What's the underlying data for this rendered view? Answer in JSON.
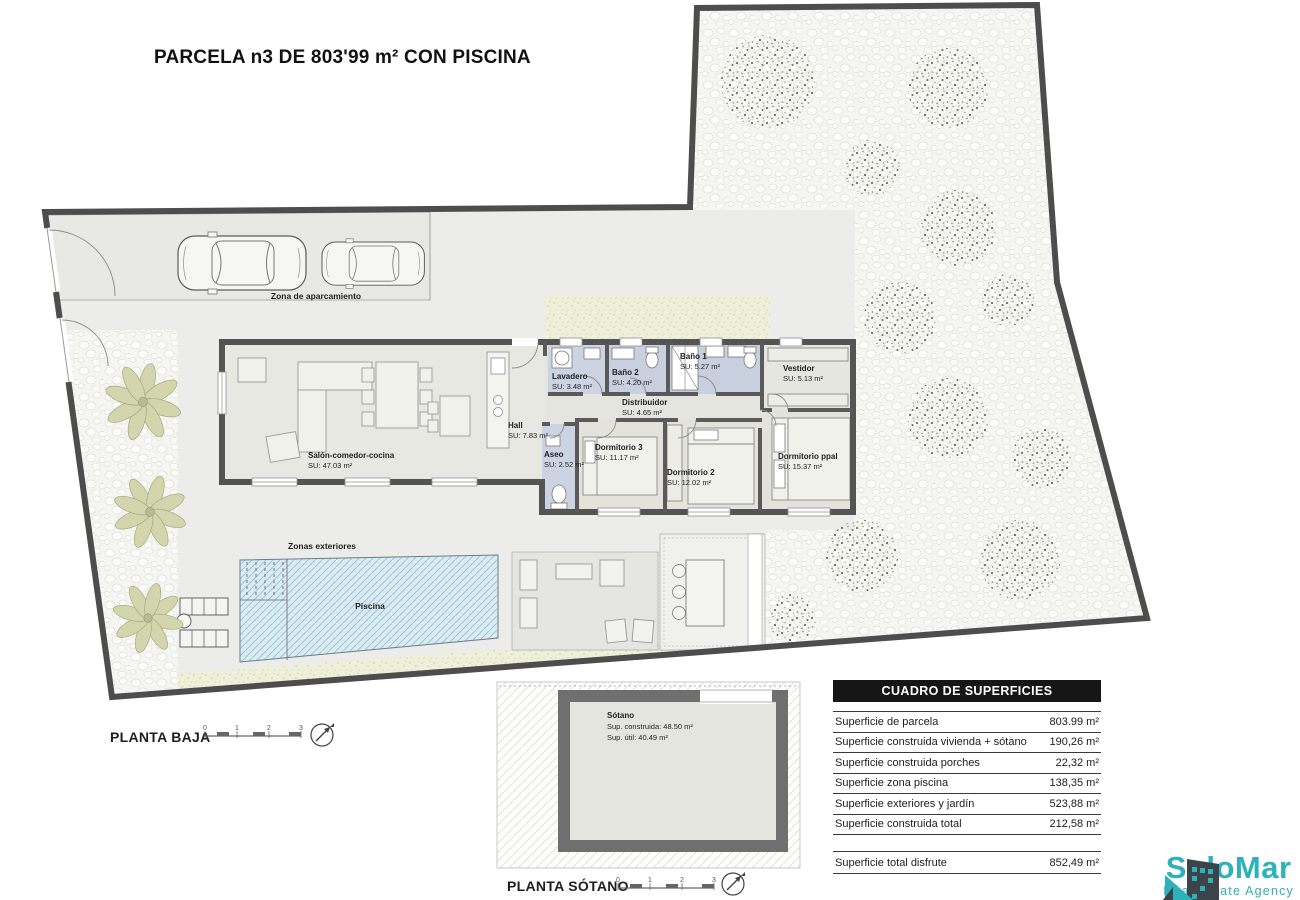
{
  "title": "PARCELA n3 DE 803'99 m² CON PISCINA",
  "plan": {
    "floor_label": "PLANTA BAJA",
    "basement_label": "PLANTA SÓTANO",
    "scale_ticks": [
      "0",
      "1",
      "2",
      "3"
    ],
    "areas": {
      "parking": "Zona de aparcamiento",
      "exterior": "Zonas exteriores",
      "pool": "Piscina"
    },
    "rooms": [
      {
        "name": "Lavadero",
        "su": "SU: 3.48 m²"
      },
      {
        "name": "Baño 2",
        "su": "SU: 4.20 m²"
      },
      {
        "name": "Baño 1",
        "su": "SU: 5.27 m²"
      },
      {
        "name": "Vestidor",
        "su": "SU: 5.13 m²"
      },
      {
        "name": "Distribuidor",
        "su": "SU: 4.65 m²"
      },
      {
        "name": "Hall",
        "su": "SU: 7.83 m²"
      },
      {
        "name": "Aseo",
        "su": "SU: 2.52 m²"
      },
      {
        "name": "Dormitorio 3",
        "su": "SU: 11.17 m²"
      },
      {
        "name": "Dormitorio 2",
        "su": "SU: 12.02 m²"
      },
      {
        "name": "Dormitorio ppal",
        "su": "SU: 15.37 m²"
      },
      {
        "name": "Salón-comedor-cocina",
        "su": "SU: 47.03 m²"
      }
    ],
    "basement": {
      "name": "Sótano",
      "built": "Sup. construida: 48.50 m²",
      "useful": "Sup. útil: 40.49 m²"
    }
  },
  "table": {
    "title": "CUADRO DE SUPERFICIES",
    "rows": [
      {
        "label": "Superficie de parcela",
        "value": "803.99 m²"
      },
      {
        "label": "Superficie construida vivienda + sótano",
        "value": "190,26 m²"
      },
      {
        "label": "Superficie construida porches",
        "value": "22,32 m²"
      },
      {
        "label": "Superficie zona piscina",
        "value": "138,35 m²"
      },
      {
        "label": "Superficie exteriores y jardín",
        "value": "523,88 m²"
      },
      {
        "label": "Superficie construida total",
        "value": "212,58 m²"
      }
    ],
    "total_row": {
      "label": "Superficie total disfrute",
      "value": "852,49 m²"
    }
  },
  "logo": {
    "name": "SoloMar",
    "tagline": "Real Estate Agency",
    "teal": "#2cb2b8",
    "dark": "#3c434a"
  }
}
